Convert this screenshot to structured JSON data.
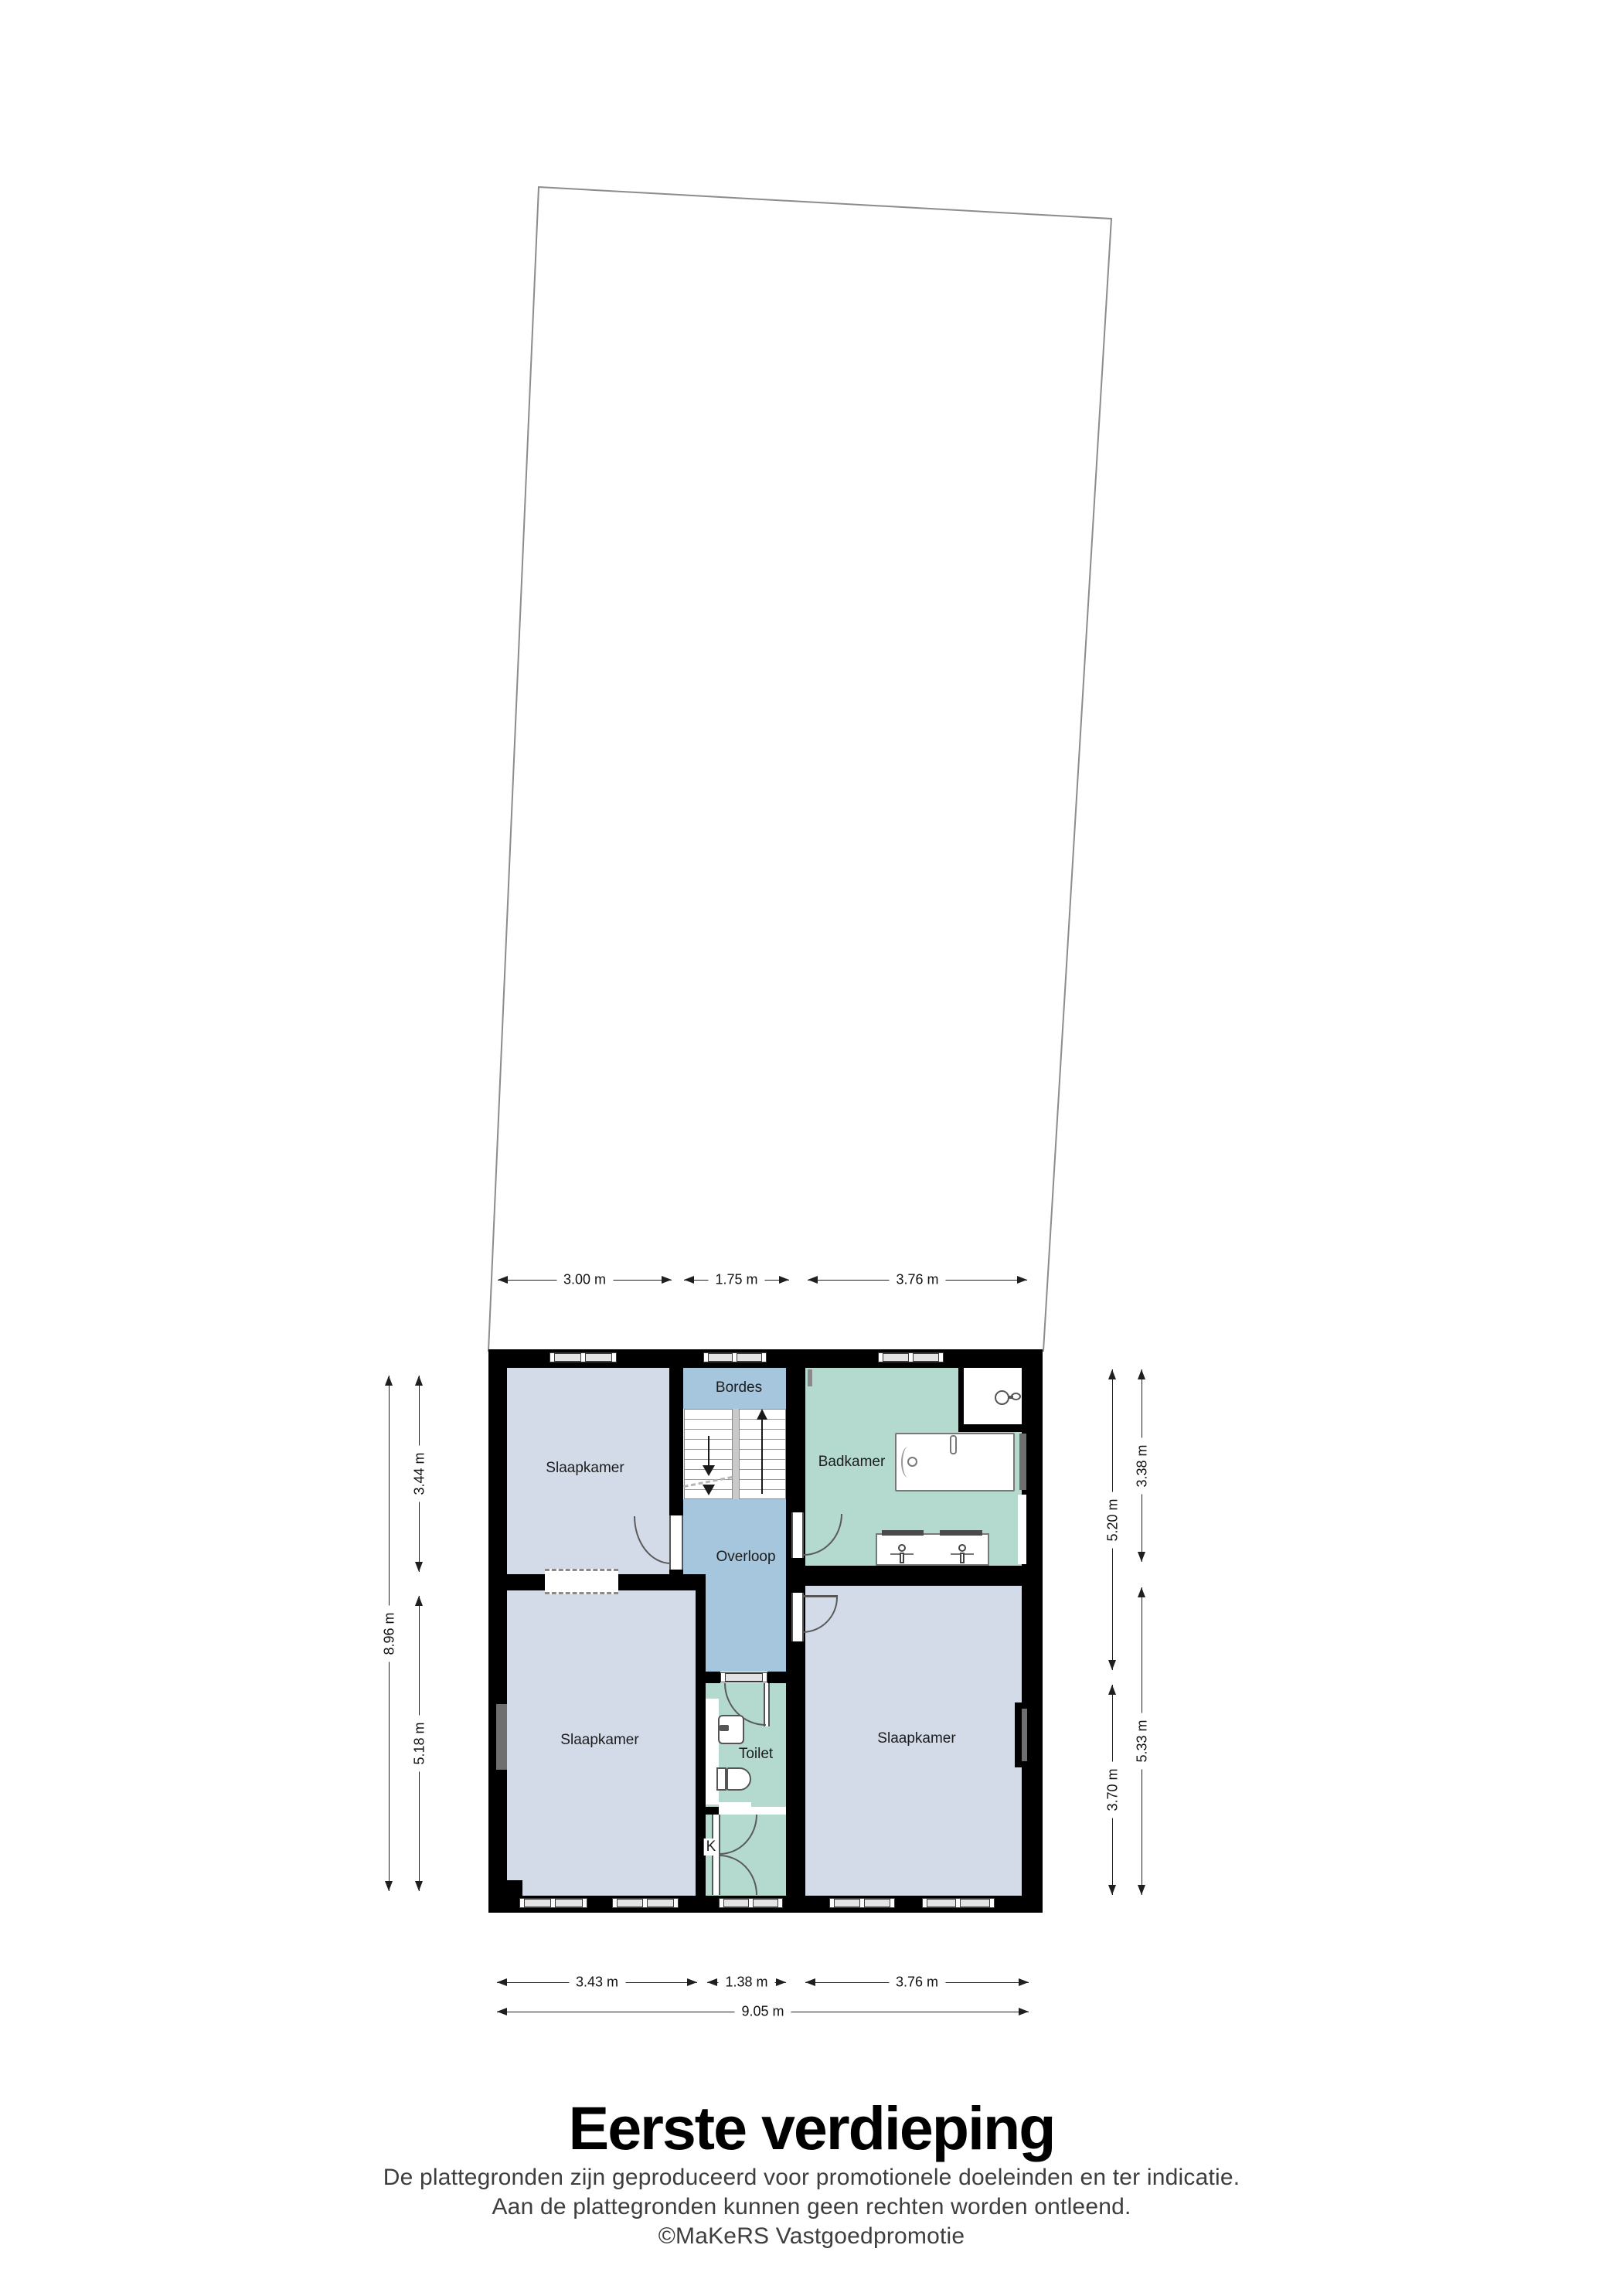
{
  "meta": {
    "floor_title": "Eerste verdieping"
  },
  "footer": {
    "line1": "De plattegronden zijn geproduceerd voor promotionele doeleinden en ter indicatie.",
    "line2": "Aan de plattegronden kunnen geen rechten worden ontleend.",
    "line3": "©MaKeRS Vastgoedpromotie"
  },
  "rooms": {
    "slaapkamer_top_left": {
      "label": "Slaapkamer"
    },
    "slaapkamer_bottom_left": {
      "label": "Slaapkamer"
    },
    "slaapkamer_right": {
      "label": "Slaapkamer"
    },
    "bordes": {
      "label": "Bordes"
    },
    "overloop": {
      "label": "Overloop"
    },
    "badkamer": {
      "label": "Badkamer"
    },
    "toilet": {
      "label": "Toilet"
    },
    "kast": {
      "label": "K"
    }
  },
  "dimensions": {
    "top": [
      {
        "label": "3.00 m"
      },
      {
        "label": "1.75 m"
      },
      {
        "label": "3.76 m"
      }
    ],
    "bottom": [
      {
        "label": "3.43 m"
      },
      {
        "label": "1.38 m"
      },
      {
        "label": "3.76 m"
      }
    ],
    "bottom_total": {
      "label": "9.05 m"
    },
    "left_total": {
      "label": "8.96 m"
    },
    "left_segments": [
      {
        "label": "3.44 m"
      },
      {
        "label": "5.18 m"
      }
    ],
    "right_segments": [
      {
        "label": "5.20 m"
      },
      {
        "label": "3.70 m"
      }
    ],
    "right_room_segments": [
      {
        "label": "3.38 m"
      },
      {
        "label": "5.33 m"
      }
    ]
  },
  "colors": {
    "wall": "#000000",
    "bedroom_fill": "#d3dbe8",
    "hall_fill": "#a6c6dd",
    "bath_fill": "#b4d9ce",
    "stair_gap": "#c9c9c9",
    "side_window": "#6f6f6f",
    "lot_stroke": "#8c8c8c",
    "dim_line": "#1f1f1f",
    "label_text": "#1c1c1c",
    "footer_text": "#3e3e3e"
  }
}
